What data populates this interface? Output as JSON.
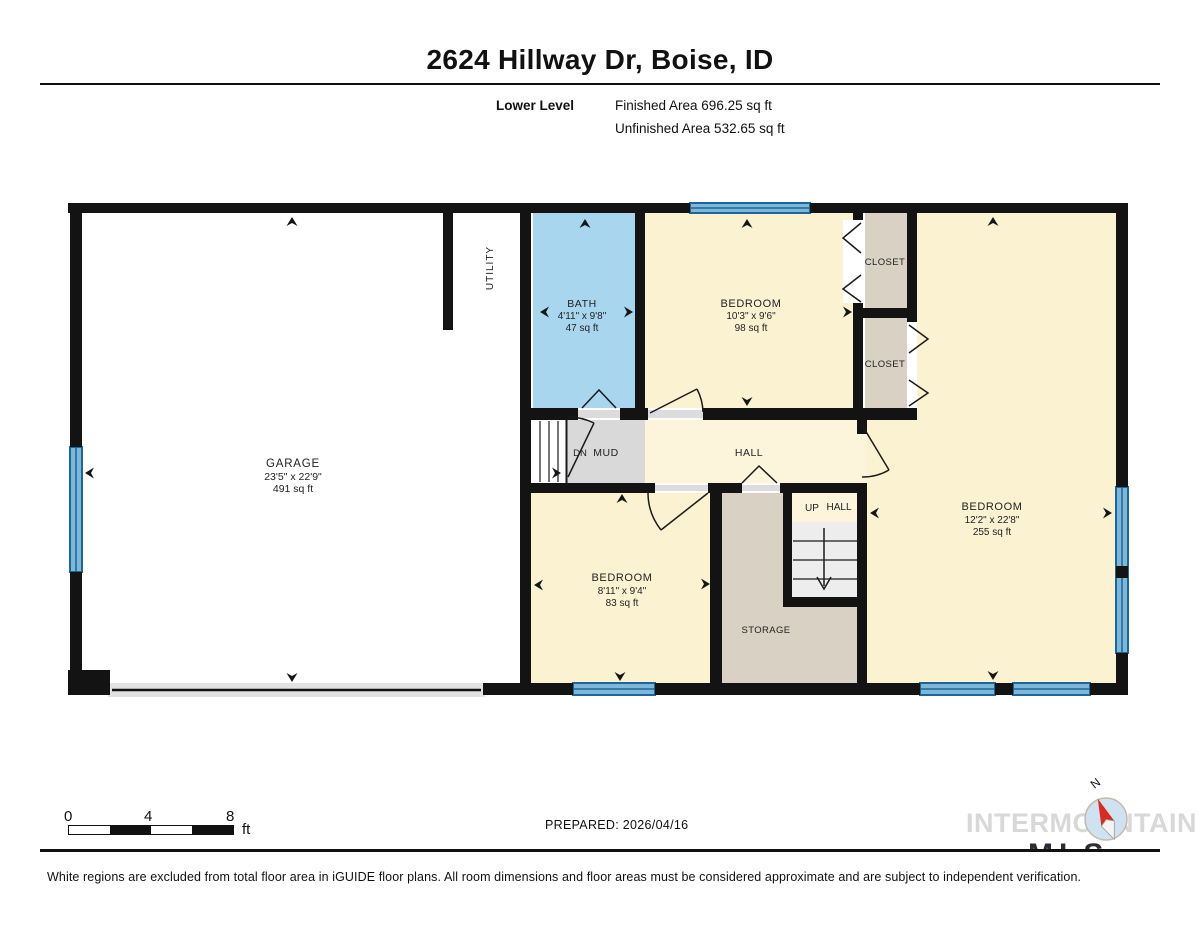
{
  "header": {
    "title": "2624 Hillway Dr, Boise, ID",
    "level_label": "Lower Level",
    "finished_area": "Finished Area 696.25 sq ft",
    "unfinished_area": "Unfinished Area 532.65 sq ft"
  },
  "floorplan": {
    "colors": {
      "wall": "#131313",
      "room_cream": "#fbf2d2",
      "hall_cream": "#fcf5dc",
      "bath_blue": "#a9d6ef",
      "closet_tan": "#d9d1c3",
      "mud_gray": "#d9d9d9",
      "stairs_gray": "#ededed",
      "window_blue": "#7cb8da",
      "window_line": "#1f6596",
      "white": "#ffffff",
      "threshold": "#dcdcdc",
      "garage_door": "#e2e2e2"
    },
    "rooms": {
      "garage": {
        "name": "GARAGE",
        "dims": "23'5\" x 22'9\"",
        "area": "491 sq ft"
      },
      "utility": {
        "name": "UTILITY"
      },
      "bath": {
        "name": "BATH",
        "dims": "4'11\" x 9'8\"",
        "area": "47 sq ft"
      },
      "bedroom_top": {
        "name": "BEDROOM",
        "dims": "10'3\" x 9'6\"",
        "area": "98 sq ft"
      },
      "closet_top": {
        "name": "CLOSET"
      },
      "closet_bottom": {
        "name": "CLOSET"
      },
      "bedroom_right": {
        "name": "BEDROOM",
        "dims": "12'2\" x 22'8\"",
        "area": "255 sq ft"
      },
      "bedroom_bottom": {
        "name": "BEDROOM",
        "dims": "8'11\" x 9'4\"",
        "area": "83 sq ft"
      },
      "storage": {
        "name": "STORAGE"
      },
      "mud": {
        "name": "MUD"
      },
      "hall": {
        "name": "HALL"
      },
      "up_hall": {
        "name": "HALL"
      },
      "dn_label": "DN",
      "up_label": "UP"
    }
  },
  "footer": {
    "scale": {
      "ticks": [
        "0",
        "4",
        "8"
      ],
      "unit": "ft"
    },
    "prepared": "PREPARED: 2026/04/16",
    "logo_text": "INTERMOUNTAIN",
    "logo_sub": "MLS",
    "compass_north": "N",
    "disclaimer": "White regions are excluded from total floor area in iGUIDE floor plans. All room dimensions and floor areas must be considered approximate and are subject to independent verification."
  }
}
